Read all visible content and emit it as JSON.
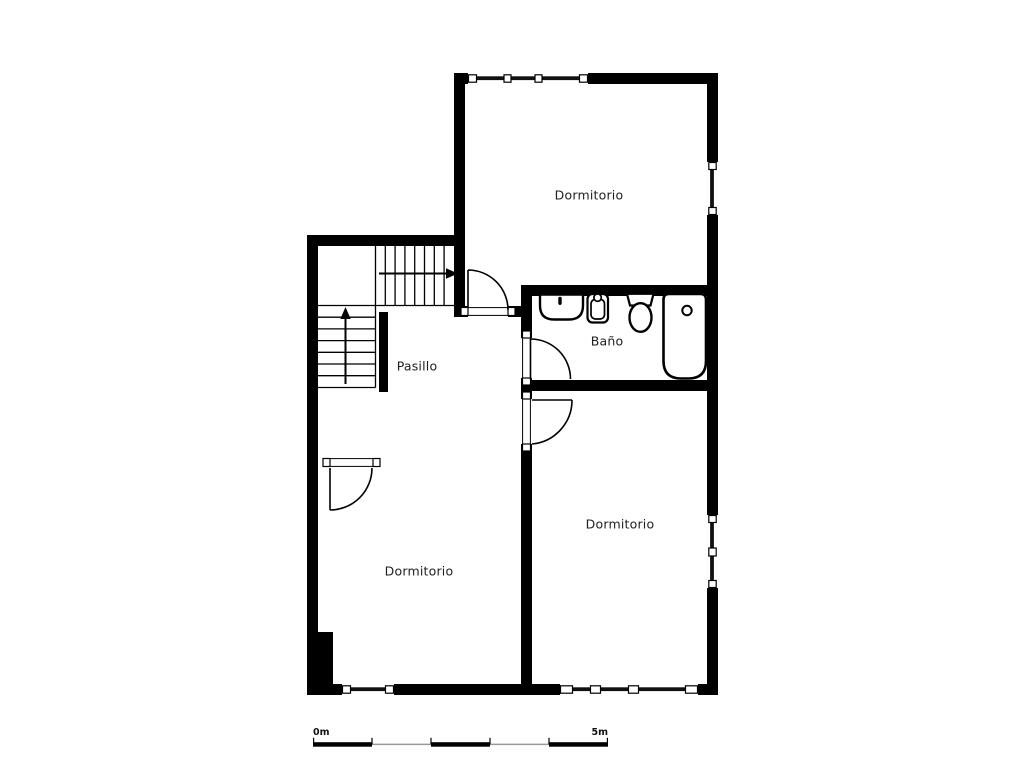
{
  "rooms": {
    "bedroom_top": {
      "label": "Dormitorio"
    },
    "bathroom": {
      "label": "Baño"
    },
    "hallway": {
      "label": "Pasillo"
    },
    "bedroom_left": {
      "label": "Dormitorio"
    },
    "bedroom_right": {
      "label": "Dormitorio"
    }
  },
  "scale_bar": {
    "start_label": "0m",
    "end_label": "5m"
  },
  "icons": {
    "fixtures": [
      "sink-icon",
      "bidet-icon",
      "toilet-icon",
      "bathtub-icon"
    ],
    "stair_arrows": [
      "arrow-up-icon",
      "arrow-right-icon"
    ]
  },
  "colors": {
    "wall": "#000000",
    "background": "#ffffff",
    "text": "#1f1f1f",
    "scale_line": "#999999"
  }
}
